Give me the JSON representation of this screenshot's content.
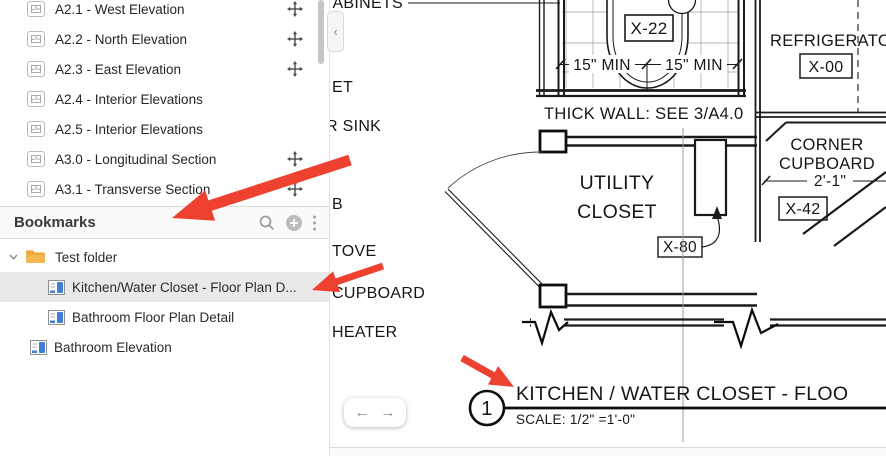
{
  "left_panel": {
    "sheet_list": {
      "items": [
        {
          "label": "A2.1 - West Elevation"
        },
        {
          "label": "A2.2 - North Elevation"
        },
        {
          "label": "A2.3 - East Elevation"
        },
        {
          "label": "A2.4 - Interior Elevations"
        },
        {
          "label": "A2.5 - Interior Elevations"
        },
        {
          "label": "A3.0 - Longitudinal Section"
        },
        {
          "label": "A3.1 - Transverse Section"
        }
      ]
    },
    "bookmarks": {
      "title": "Bookmarks",
      "folder_label": "Test folder",
      "items": [
        {
          "label": "Kitchen/Water Closet - Floor Plan D..."
        },
        {
          "label": "Bathroom Floor Plan Detail"
        },
        {
          "label": "Bathroom Elevation"
        }
      ]
    }
  },
  "panel_toggle": {
    "collapse_icon": "‹"
  },
  "nav": {
    "back_icon": "←",
    "forward_icon": "→"
  },
  "drawing": {
    "labels": {
      "cabinets_fragment": "ABINETS",
      "closet_fragment": "ET",
      "sink_fragment": "R SINK",
      "b_fragment": "B",
      "stove_fragment": "TOVE",
      "cupboard_fragment": "CUPBOARD",
      "heater_fragment": "HEATER",
      "wc_tag": "X-22",
      "dim_left": "15\" MIN",
      "dim_right": "15\" MIN",
      "thick_wall_note": "THICK WALL: SEE 3/A4.0",
      "refrigerator": "REFRIGERATOR",
      "refrigerator_tag": "X-00",
      "corner_cupboard_line1": "CORNER",
      "corner_cupboard_line2": "CUPBOARD",
      "corner_cupboard_dim": "2'-1\"",
      "corner_cupboard_tag": "X-42",
      "utility_line1": "UTILITY",
      "utility_line2": "CLOSET",
      "utility_tag": "X-80",
      "detail_number": "1",
      "detail_title": "KITCHEN / WATER CLOSET - FLOO",
      "detail_scale": "SCALE: 1/2\" =1'-0\""
    }
  },
  "colors": {
    "annotation_red": "#EF4130",
    "selected_row": "#E9E9E9",
    "folder_orange": "#ECA93C",
    "bookmark_blue": "#3E7FD4"
  }
}
